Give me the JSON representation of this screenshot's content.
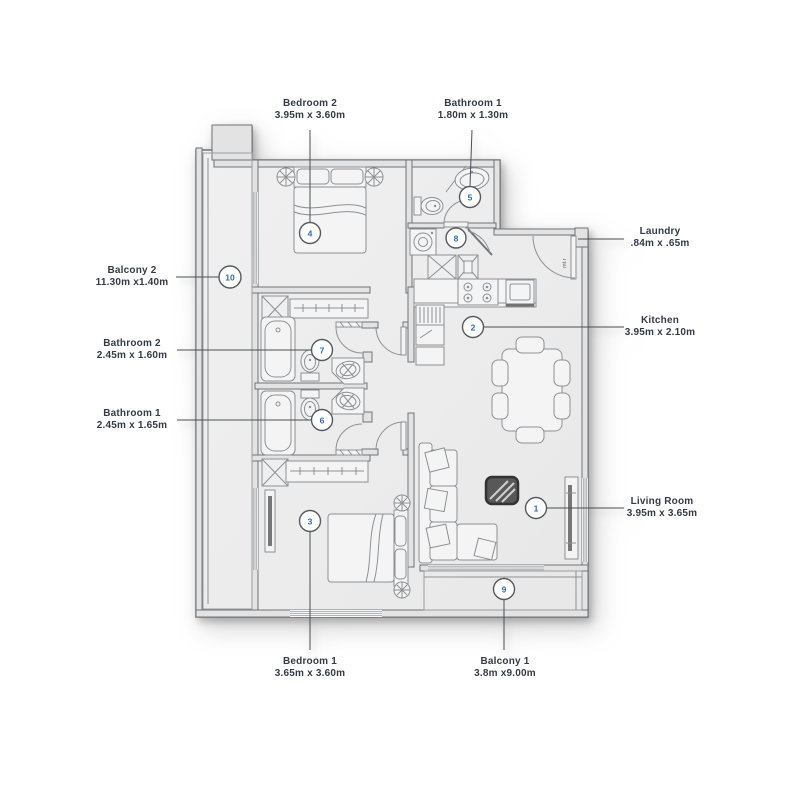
{
  "floorplan": {
    "labels": {
      "bedroom2": {
        "name": "Bedroom 2",
        "dims": "3.95m x 3.60m"
      },
      "bathroom1_top": {
        "name": "Bathroom 1",
        "dims": "1.80m x 1.30m"
      },
      "laundry": {
        "name": "Laundry",
        "dims": ".84m x .65m"
      },
      "kitchen": {
        "name": "Kitchen",
        "dims": "3.95m x 2.10m"
      },
      "balcony2": {
        "name": "Balcony 2",
        "dims": "11.30m x1.40m"
      },
      "bathroom2": {
        "name": "Bathroom 2",
        "dims": "2.45m x 1.60m"
      },
      "bathroom1": {
        "name": "Bathroom 1",
        "dims": "2.45m x 1.65m"
      },
      "living_room": {
        "name": "Living Room",
        "dims": "3.95m x 3.65m"
      },
      "bedroom1": {
        "name": "Bedroom 1",
        "dims": "3.65m x 3.60m"
      },
      "balcony1": {
        "name": "Balcony 1",
        "dims": "3.8m x9.00m"
      }
    },
    "markers": {
      "m1": "1",
      "m2": "2",
      "m3": "3",
      "m4": "4",
      "m5": "5",
      "m6": "6",
      "m7": "7",
      "m8": "8",
      "m9": "9",
      "m10": "10"
    },
    "annotations": {
      "meter_room": "mt.r"
    },
    "colors": {
      "marker_number": "#2e6da4",
      "label_text": "#343b45",
      "wall_line": "#6f7376",
      "floor_fill": "#ececec"
    }
  }
}
